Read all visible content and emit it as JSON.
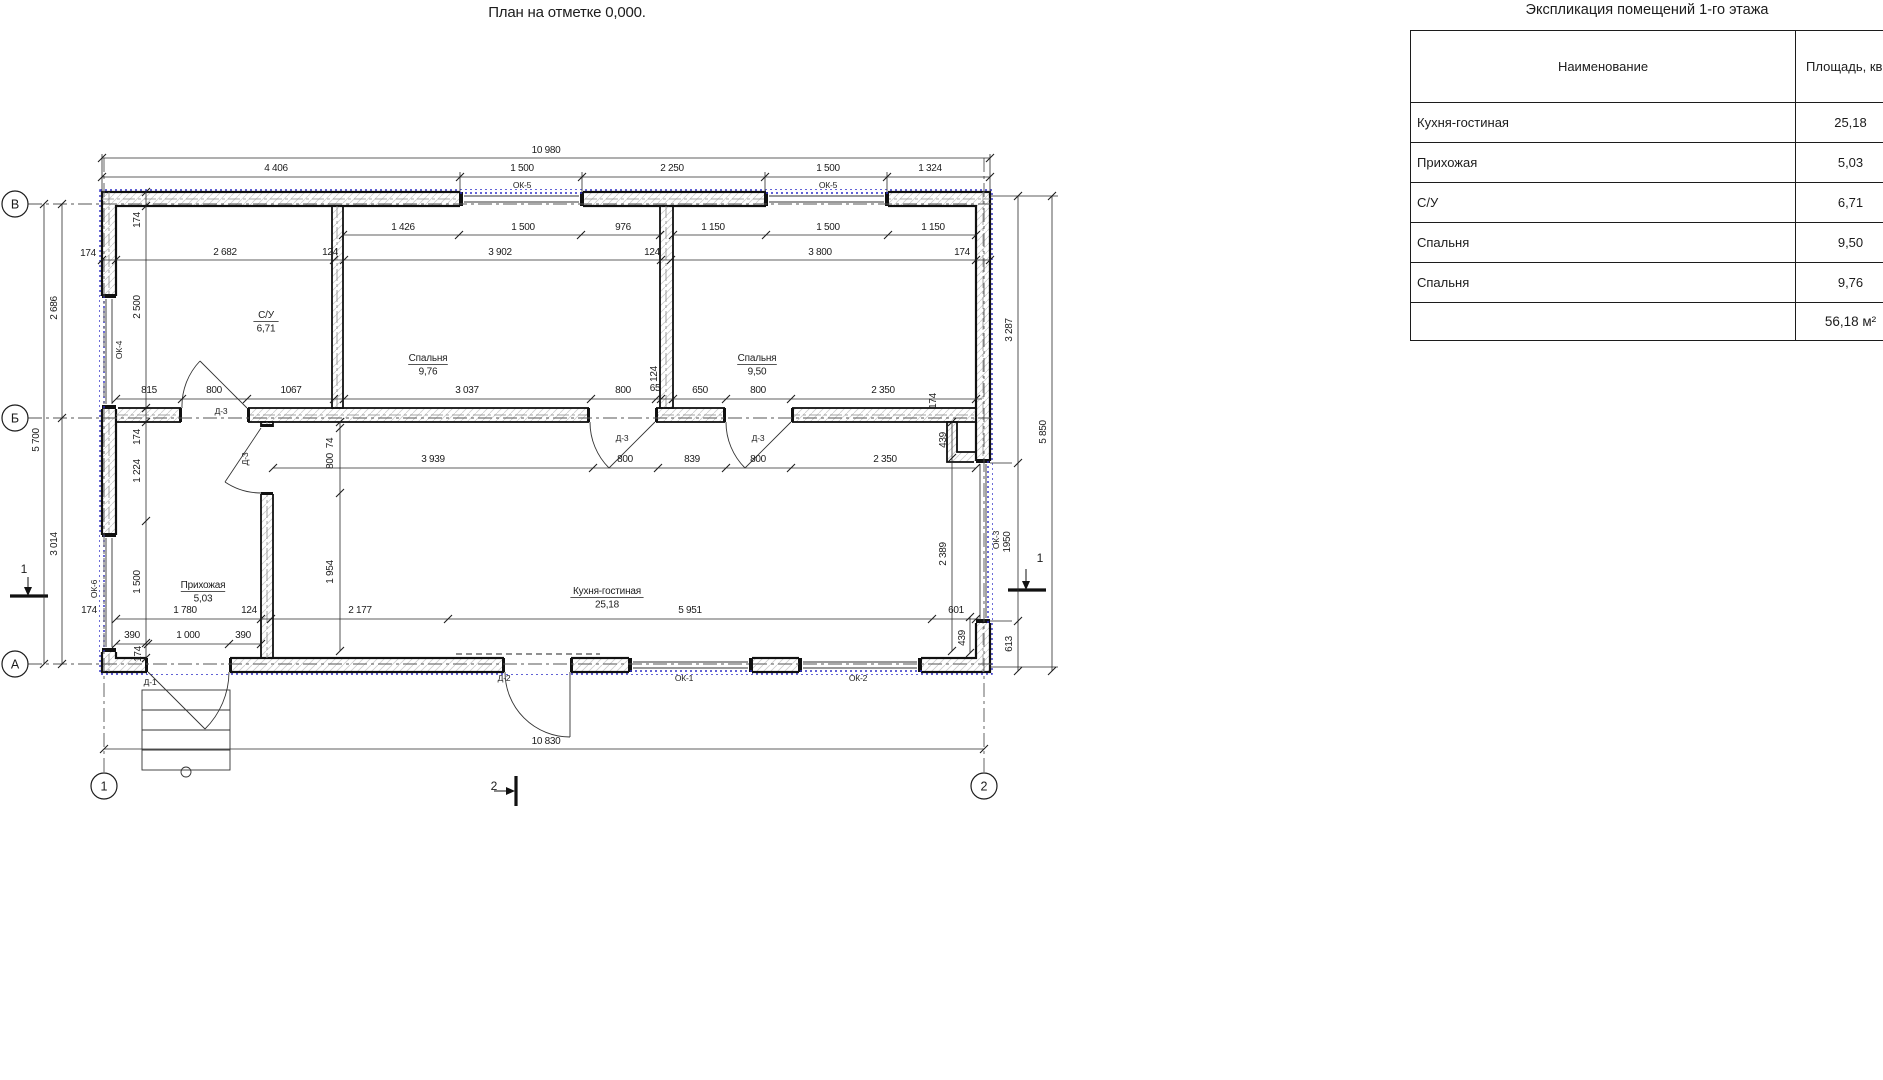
{
  "plan": {
    "title": "План на отметке 0,000.",
    "axis_bubbles": [
      {
        "label": "В",
        "x": 15,
        "y": 204
      },
      {
        "label": "Б",
        "x": 15,
        "y": 418
      },
      {
        "label": "А",
        "x": 15,
        "y": 664
      },
      {
        "label": "1",
        "x": 104,
        "y": 786
      },
      {
        "label": "2",
        "x": 984,
        "y": 786
      }
    ],
    "section_marks": [
      {
        "label": "1",
        "x": 24,
        "y": 573
      },
      {
        "label": "1",
        "x": 1040,
        "y": 562
      },
      {
        "label": "2",
        "x": 494,
        "y": 790
      }
    ],
    "rooms": [
      {
        "name": "С/У",
        "area": "6,71",
        "x": 266,
        "y": 318
      },
      {
        "name": "Спальня",
        "area": "9,76",
        "x": 428,
        "y": 361
      },
      {
        "name": "Спальня",
        "area": "9,50",
        "x": 757,
        "y": 361
      },
      {
        "name": "Прихожая",
        "area": "5,03",
        "x": 203,
        "y": 588
      },
      {
        "name": "Кухня-гостиная",
        "area": "25,18",
        "x": 607,
        "y": 594
      }
    ],
    "dim_labels": [
      [
        "10 980",
        546,
        153
      ],
      [
        "4 406",
        276,
        171
      ],
      [
        "1 500",
        522,
        171
      ],
      [
        "2 250",
        672,
        171
      ],
      [
        "1 500",
        828,
        171
      ],
      [
        "1 324",
        930,
        171
      ],
      [
        "1 426",
        403,
        230
      ],
      [
        "1 500",
        523,
        230
      ],
      [
        "976",
        623,
        230
      ],
      [
        "1 150",
        713,
        230
      ],
      [
        "1 500",
        828,
        230
      ],
      [
        "1 150",
        933,
        230
      ],
      [
        "174",
        88,
        256
      ],
      [
        "2 682",
        225,
        255
      ],
      [
        "124",
        330,
        255
      ],
      [
        "3 902",
        500,
        255
      ],
      [
        "124",
        652,
        255
      ],
      [
        "3 800",
        820,
        255
      ],
      [
        "174",
        962,
        255
      ],
      [
        "815",
        149,
        393
      ],
      [
        "800",
        214,
        393
      ],
      [
        "1067",
        291,
        393
      ],
      [
        "3 037",
        467,
        393
      ],
      [
        "800",
        623,
        393
      ],
      [
        "65",
        655,
        391
      ],
      [
        "650",
        700,
        393
      ],
      [
        "800",
        758,
        393
      ],
      [
        "2 350",
        883,
        393
      ],
      [
        "3 939",
        433,
        462
      ],
      [
        "800",
        625,
        462
      ],
      [
        "839",
        692,
        462
      ],
      [
        "800",
        758,
        462
      ],
      [
        "2 350",
        885,
        462
      ],
      [
        "1 780",
        185,
        613
      ],
      [
        "124",
        249,
        613
      ],
      [
        "2 177",
        360,
        613
      ],
      [
        "5 951",
        690,
        613
      ],
      [
        "601",
        956,
        613
      ],
      [
        "174",
        89,
        613
      ],
      [
        "390",
        132,
        638
      ],
      [
        "1 000",
        188,
        638
      ],
      [
        "390",
        243,
        638
      ],
      [
        "10 830",
        546,
        744
      ]
    ],
    "dim_labels_rotated": [
      [
        "2 686",
        57,
        308
      ],
      [
        "5 700",
        39,
        440
      ],
      [
        "3 014",
        57,
        544
      ],
      [
        "174",
        140,
        220
      ],
      [
        "2 500",
        140,
        307
      ],
      [
        "174",
        140,
        437
      ],
      [
        "1 224",
        140,
        471
      ],
      [
        "1 500",
        140,
        582
      ],
      [
        "174",
        141,
        654
      ],
      [
        "74",
        333,
        443
      ],
      [
        "800",
        333,
        461
      ],
      [
        "1 954",
        333,
        572
      ],
      [
        "124",
        657,
        374
      ],
      [
        "174",
        936,
        401
      ],
      [
        "439",
        946,
        440
      ],
      [
        "2 389",
        946,
        554
      ],
      [
        "439",
        965,
        638
      ],
      [
        "3 287",
        1012,
        330
      ],
      [
        "1950",
        1010,
        542
      ],
      [
        "613",
        1012,
        644
      ],
      [
        "5 850",
        1046,
        432
      ]
    ],
    "opening_labels": [
      {
        "t": "ОК-5",
        "x": 522,
        "y": 188,
        "rot": 0
      },
      {
        "t": "ОК-5",
        "x": 828,
        "y": 188,
        "rot": 0
      },
      {
        "t": "ОК-4",
        "x": 122,
        "y": 350,
        "rot": 1
      },
      {
        "t": "ОК-6",
        "x": 97,
        "y": 589,
        "rot": 1
      },
      {
        "t": "ОК-3",
        "x": 999,
        "y": 540,
        "rot": 1
      },
      {
        "t": "ОК-1",
        "x": 684,
        "y": 681,
        "rot": 0
      },
      {
        "t": "ОК-2",
        "x": 858,
        "y": 681,
        "rot": 0
      },
      {
        "t": "Д-2",
        "x": 504,
        "y": 681,
        "rot": 0
      },
      {
        "t": "Д-1",
        "x": 150,
        "y": 685,
        "rot": 0
      },
      {
        "t": "Д-3",
        "x": 221,
        "y": 414,
        "rot": 0
      },
      {
        "t": "Д-3",
        "x": 622,
        "y": 441,
        "rot": 0
      },
      {
        "t": "Д-3",
        "x": 758,
        "y": 441,
        "rot": 0
      },
      {
        "t": "Д-3",
        "x": 248,
        "y": 459,
        "rot": 1
      }
    ]
  },
  "table": {
    "title": "Экспликация помещений 1-го этажа",
    "columns": [
      "Наименование",
      "Площадь, кв.м"
    ],
    "rows": [
      {
        "name": "Кухня-гостиная",
        "area": "25,18"
      },
      {
        "name": "Прихожая",
        "area": "5,03"
      },
      {
        "name": "С/У",
        "area": "6,71"
      },
      {
        "name": "Спальня",
        "area": "9,50"
      },
      {
        "name": "Спальня",
        "area": "9,76"
      }
    ],
    "total": "56,18 м²"
  },
  "colors": {
    "ink": "#1c1c1c",
    "blue": "#2e2ec8",
    "hatch": "#cccccc"
  }
}
